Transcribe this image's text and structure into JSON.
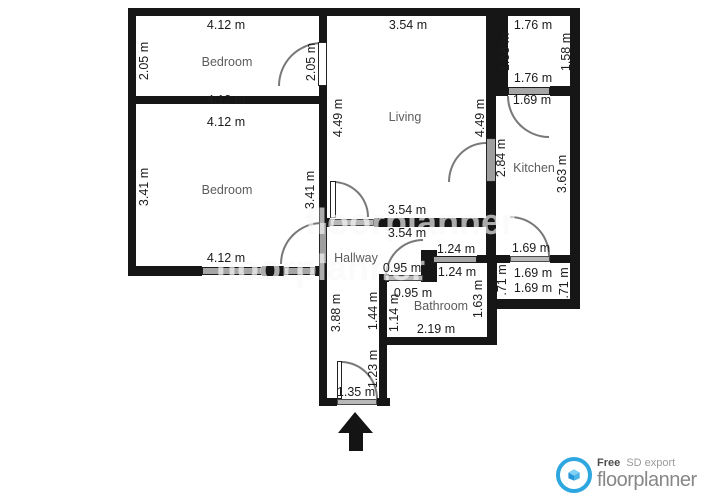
{
  "plan": {
    "rooms": [
      {
        "label": "Bedroom",
        "x": 227,
        "y": 62
      },
      {
        "label": "Bedroom",
        "x": 227,
        "y": 190
      },
      {
        "label": "Living",
        "x": 405,
        "y": 117
      },
      {
        "label": "Kitchen",
        "x": 534,
        "y": 168
      },
      {
        "label": "Hallway",
        "x": 356,
        "y": 258
      },
      {
        "label": "Bathroom",
        "x": 441,
        "y": 306
      }
    ],
    "dimensions": [
      {
        "text": "4.12 m",
        "x": 226,
        "y": 25
      },
      {
        "text": "2.05 m",
        "x": 144,
        "y": 61,
        "v": true
      },
      {
        "text": "2.05 m",
        "x": 311,
        "y": 62,
        "v": true
      },
      {
        "text": "4.12 m",
        "x": 226,
        "y": 100
      },
      {
        "text": "4.12 m",
        "x": 226,
        "y": 122
      },
      {
        "text": "3.41 m",
        "x": 144,
        "y": 187,
        "v": true
      },
      {
        "text": "3.41 m",
        "x": 310,
        "y": 190,
        "v": true
      },
      {
        "text": "4.12 m",
        "x": 226,
        "y": 258
      },
      {
        "text": "3.54 m",
        "x": 408,
        "y": 25
      },
      {
        "text": "4.49 m",
        "x": 338,
        "y": 118,
        "v": true
      },
      {
        "text": "4.49 m",
        "x": 480,
        "y": 118,
        "v": true
      },
      {
        "text": "3.54 m",
        "x": 407,
        "y": 210
      },
      {
        "text": "3.54 m",
        "x": 407,
        "y": 233
      },
      {
        "text": "1.76 m",
        "x": 533,
        "y": 25
      },
      {
        "text": "1.58 m",
        "x": 505,
        "y": 52,
        "v": true
      },
      {
        "text": "1.58 m",
        "x": 566,
        "y": 52,
        "v": true
      },
      {
        "text": "1.76 m",
        "x": 533,
        "y": 78
      },
      {
        "text": "1.69 m",
        "x": 532,
        "y": 100
      },
      {
        "text": "2.84 m",
        "x": 501,
        "y": 158,
        "v": true
      },
      {
        "text": "3.63 m",
        "x": 562,
        "y": 174,
        "v": true
      },
      {
        "text": "1.69 m",
        "x": 531,
        "y": 248
      },
      {
        "text": ".71 m",
        "x": 502,
        "y": 280,
        "v": true
      },
      {
        "text": "1.69 m",
        "x": 533,
        "y": 273
      },
      {
        "text": "1.69 m",
        "x": 533,
        "y": 288
      },
      {
        "text": ".71 m",
        "x": 564,
        "y": 283,
        "v": true
      },
      {
        "text": "1.24 m",
        "x": 456,
        "y": 249
      },
      {
        "text": "1.24 m",
        "x": 457,
        "y": 272
      },
      {
        "text": "0.95 m",
        "x": 402,
        "y": 268
      },
      {
        "text": "0.95 m",
        "x": 413,
        "y": 293
      },
      {
        "text": "1.63 m",
        "x": 478,
        "y": 299,
        "v": true
      },
      {
        "text": "2.19 m",
        "x": 436,
        "y": 329
      },
      {
        "text": "3.88 m",
        "x": 336,
        "y": 313,
        "v": true
      },
      {
        "text": "1.44 m",
        "x": 373,
        "y": 311,
        "v": true
      },
      {
        "text": "1.14 m",
        "x": 394,
        "y": 313,
        "v": true
      },
      {
        "text": "1.23 m",
        "x": 373,
        "y": 369,
        "v": true
      },
      {
        "text": "1.35 m",
        "x": 356,
        "y": 392
      }
    ]
  },
  "watermark": {
    "text": "floorplanner",
    "spots": [
      {
        "x": 410,
        "y": 222
      },
      {
        "x": 320,
        "y": 268
      }
    ]
  },
  "branding": {
    "free_label": "Free",
    "export_label": "SD export",
    "brand_name": "floorplanner"
  }
}
